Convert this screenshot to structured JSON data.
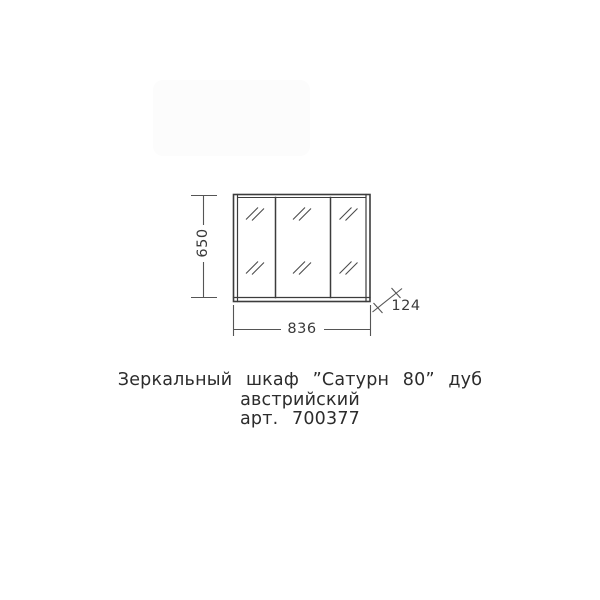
{
  "drawing": {
    "subject": "mirror-cabinet-front-view-three-doors",
    "line_color": "#3c3c3c",
    "dimensions": {
      "height": "650",
      "width": "836",
      "depth": "124"
    }
  },
  "caption": {
    "title_line1": "Зеркальный шкаф ”Сатурн 80” дуб",
    "title_line2": "австрийский",
    "article": "арт. 700377"
  }
}
